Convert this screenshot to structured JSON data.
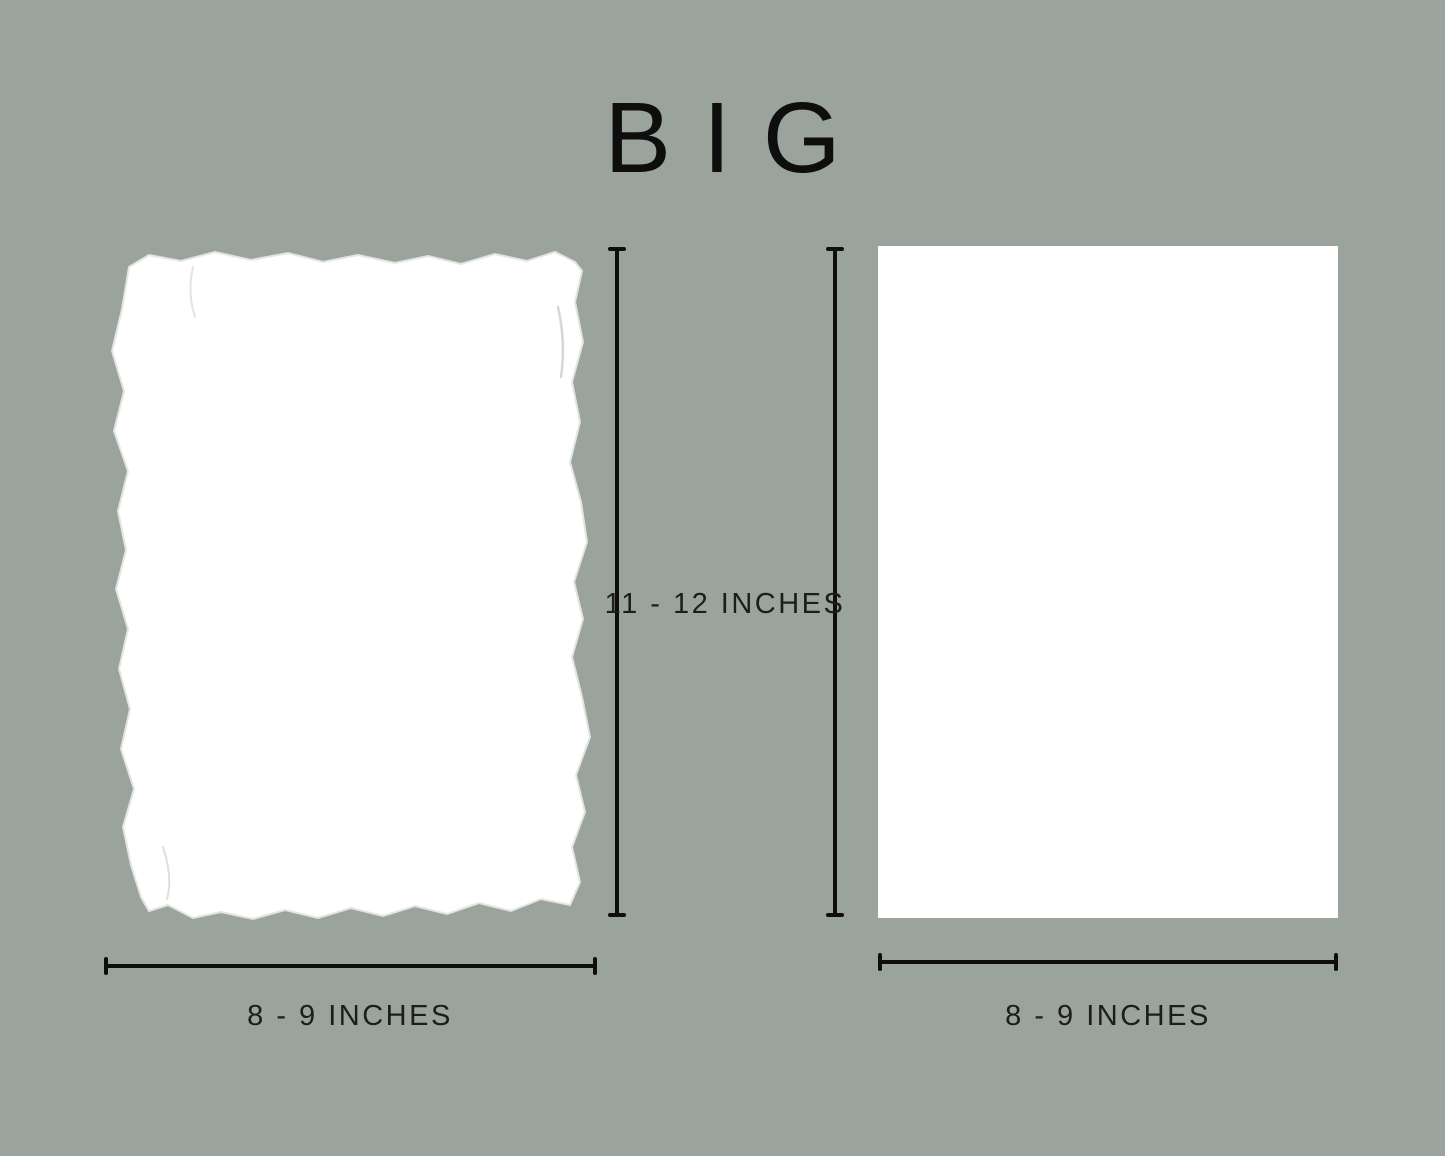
{
  "title": "BIG",
  "figures": {
    "left": {
      "name": "deckle-edge-paper"
    },
    "right": {
      "name": "straight-edge-paper"
    }
  },
  "dimensions": {
    "height": {
      "label": "11 - 12 INCHES"
    },
    "left_width": {
      "label": "8 - 9 INCHES"
    },
    "right_width": {
      "label": "8 - 9 INCHES"
    }
  },
  "colors": {
    "background": "#9AA49C",
    "paper": "#FFFFFF",
    "line": "#0E0E0E",
    "text": "#1D1D1D"
  }
}
